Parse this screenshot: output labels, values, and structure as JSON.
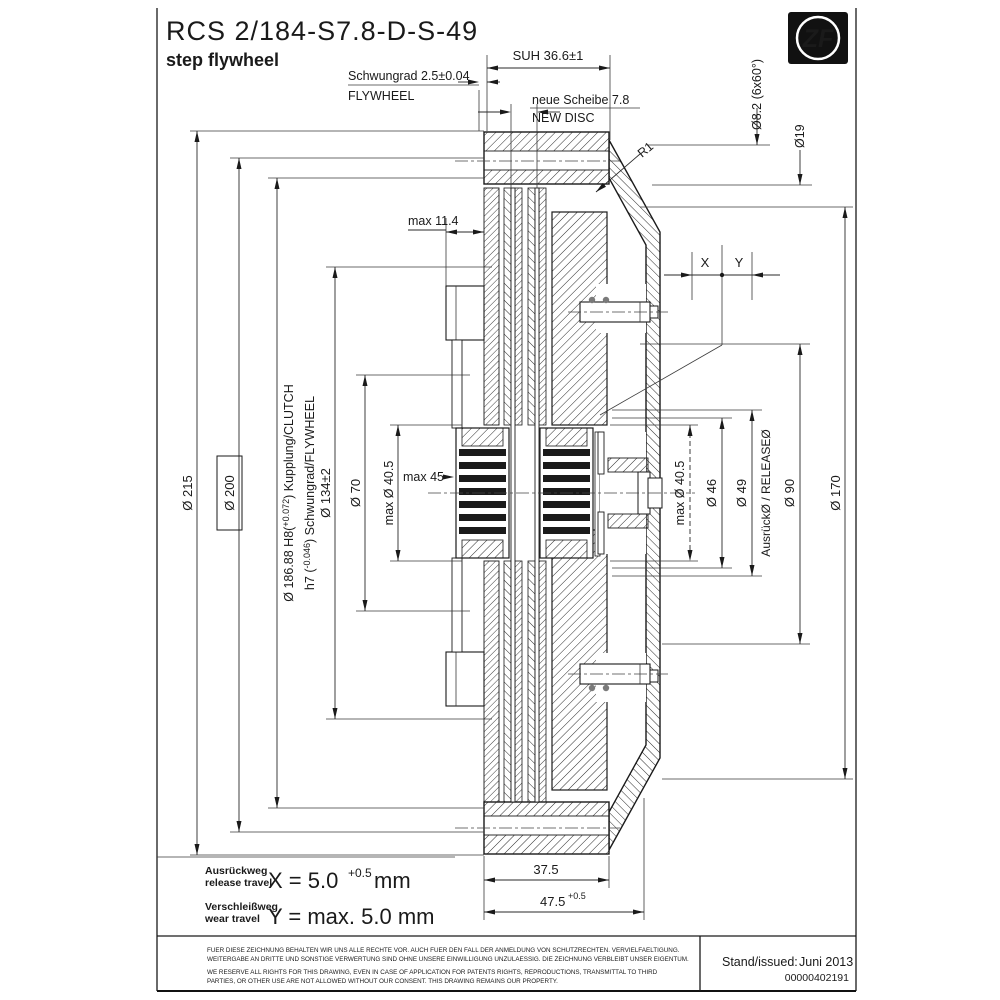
{
  "title": {
    "part_number": "RCS 2/184-S7.8-D-S-49",
    "subtitle": "step flywheel"
  },
  "logo": {
    "text": "ZF"
  },
  "dims": {
    "suh": "SUH 36.6±1",
    "flywheel_de": "Schwungrad 2.5±0.04",
    "flywheel_en": "FLYWHEEL",
    "new_disc_de": "neue Scheibe 7.8",
    "new_disc_en": "NEW DISC",
    "hole_pattern": "Ø8.2 (6x60°)",
    "d19": "Ø19",
    "r1": "R1",
    "max_114": "max 11.4",
    "x_label": "X",
    "y_label": "Y",
    "d215": "Ø 215",
    "d200": "Ø 200",
    "d18688_pre": "Ø 186.88 H8(",
    "d18688_tol": "+0.072",
    "d18688_post": ") Kupplung/CLUTCH",
    "h7_pre": "h7 (",
    "h7_tol": "-0.046",
    "h7_post": ") Schwungrad/FLYWHEEL",
    "d134": "Ø 134±2",
    "d70": "Ø 70",
    "max_d405_left": "max Ø 40.5",
    "max_45": "max 45",
    "max_d405_right": "max Ø 40.5",
    "d46": "Ø 46",
    "d49": "Ø 49",
    "release_dia": "AusrückØ / RELEASEØ",
    "d90": "Ø 90",
    "d170": "Ø 170",
    "w375": "37.5",
    "w475": "47.5",
    "w475_tol": "+0.5"
  },
  "travel": {
    "release_de": "Ausrückweg",
    "release_en": "release travel",
    "release_formula": "X = 5.0",
    "release_tol": "+0.5",
    "release_unit": "mm",
    "wear_de": "Verschleißweg",
    "wear_en": "wear travel",
    "wear_formula": "Y = max. 5.0 mm"
  },
  "footer": {
    "de1": "FUER DIESE ZEICHNUNG BEHALTEN WIR UNS ALLE RECHTE VOR. AUCH FUER DEN FALL DER ANMELDUNG VON SCHUTZRECHTEN. VERVIELFAELTIGUNG.",
    "de2": "WEITERGABE AN DRITTE UND SONSTIGE VERWERTUNG SIND OHNE UNSERE EINWILLIGUNG UNZULAESSIG. DIE ZEICHNUNG VERBLEIBT UNSER EIGENTUM.",
    "en1": "WE RESERVE ALL RIGHTS FOR THIS DRAWING, EVEN IN CASE OF APPLICATION FOR PATENTS RIGHTS, REPRODUCTIONS, TRANSMITTAL TO THIRD",
    "en2": "PARTIES, OR OTHER USE ARE NOT ALLOWED WITHOUT OUR CONSENT. THIS DRAWING REMAINS OUR PROPERTY.",
    "issued_label": "Stand/issued:",
    "issued_value": "Juni 2013",
    "doc_number": "00000402191"
  },
  "colors": {
    "line": "#1a1a1a",
    "background": "#ffffff"
  }
}
